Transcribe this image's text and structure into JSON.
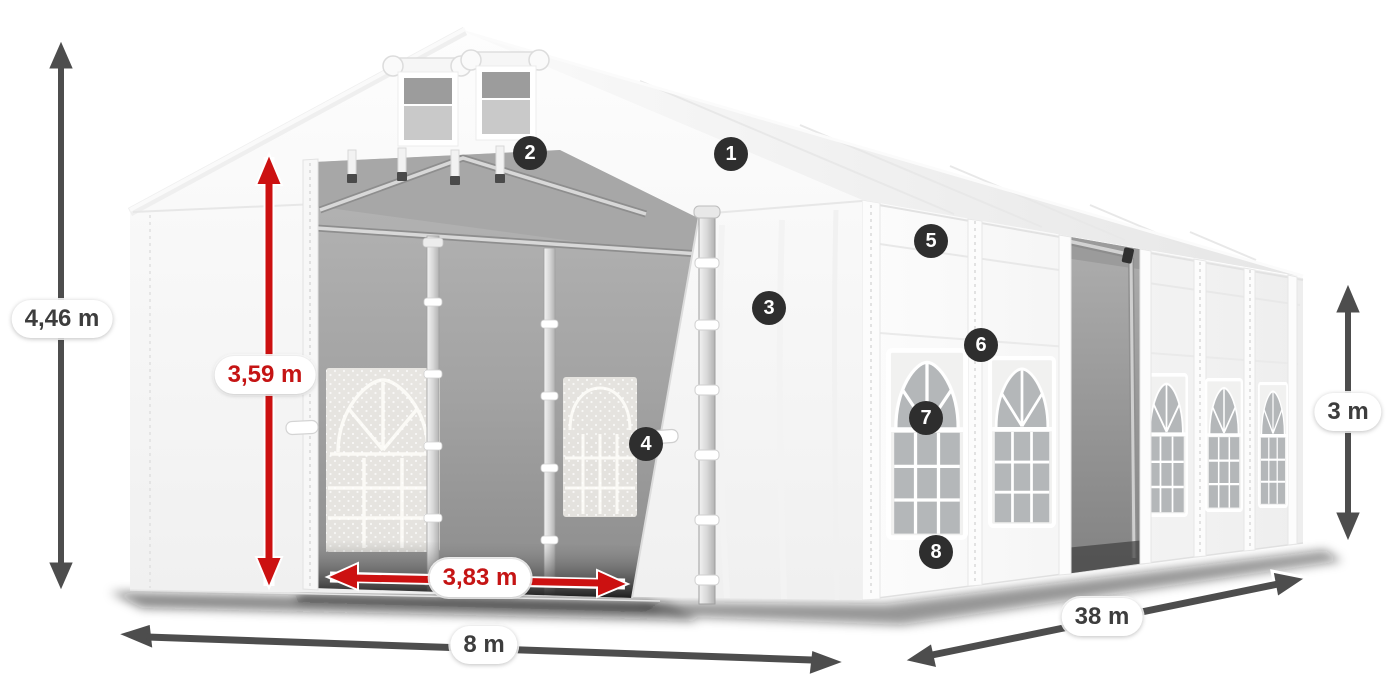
{
  "dimensions": {
    "total_height": {
      "label": "4,46 m",
      "style": "gray"
    },
    "inner_height": {
      "label": "3,59 m",
      "style": "red"
    },
    "entrance_width": {
      "label": "3,83 m",
      "style": "red"
    },
    "width": {
      "label": "8 m",
      "style": "gray"
    },
    "length": {
      "label": "38 m",
      "style": "gray"
    },
    "side_height": {
      "label": "3 m",
      "style": "gray"
    }
  },
  "callouts": [
    {
      "number": "1"
    },
    {
      "number": "2"
    },
    {
      "number": "3"
    },
    {
      "number": "4"
    },
    {
      "number": "5"
    },
    {
      "number": "6"
    },
    {
      "number": "7"
    },
    {
      "number": "8"
    }
  ],
  "colors": {
    "dimension_red": "#cc1111",
    "dimension_gray": "#4d4d4d",
    "label_text_gray": "#3d3d3d",
    "label_text_red": "#c51414",
    "callout_background": "#2e2e2e",
    "callout_text": "#ffffff",
    "canvas_background": "#ffffff",
    "tent_fabric": "#f7f7f7",
    "interior_gray": "#a2a2a2"
  }
}
